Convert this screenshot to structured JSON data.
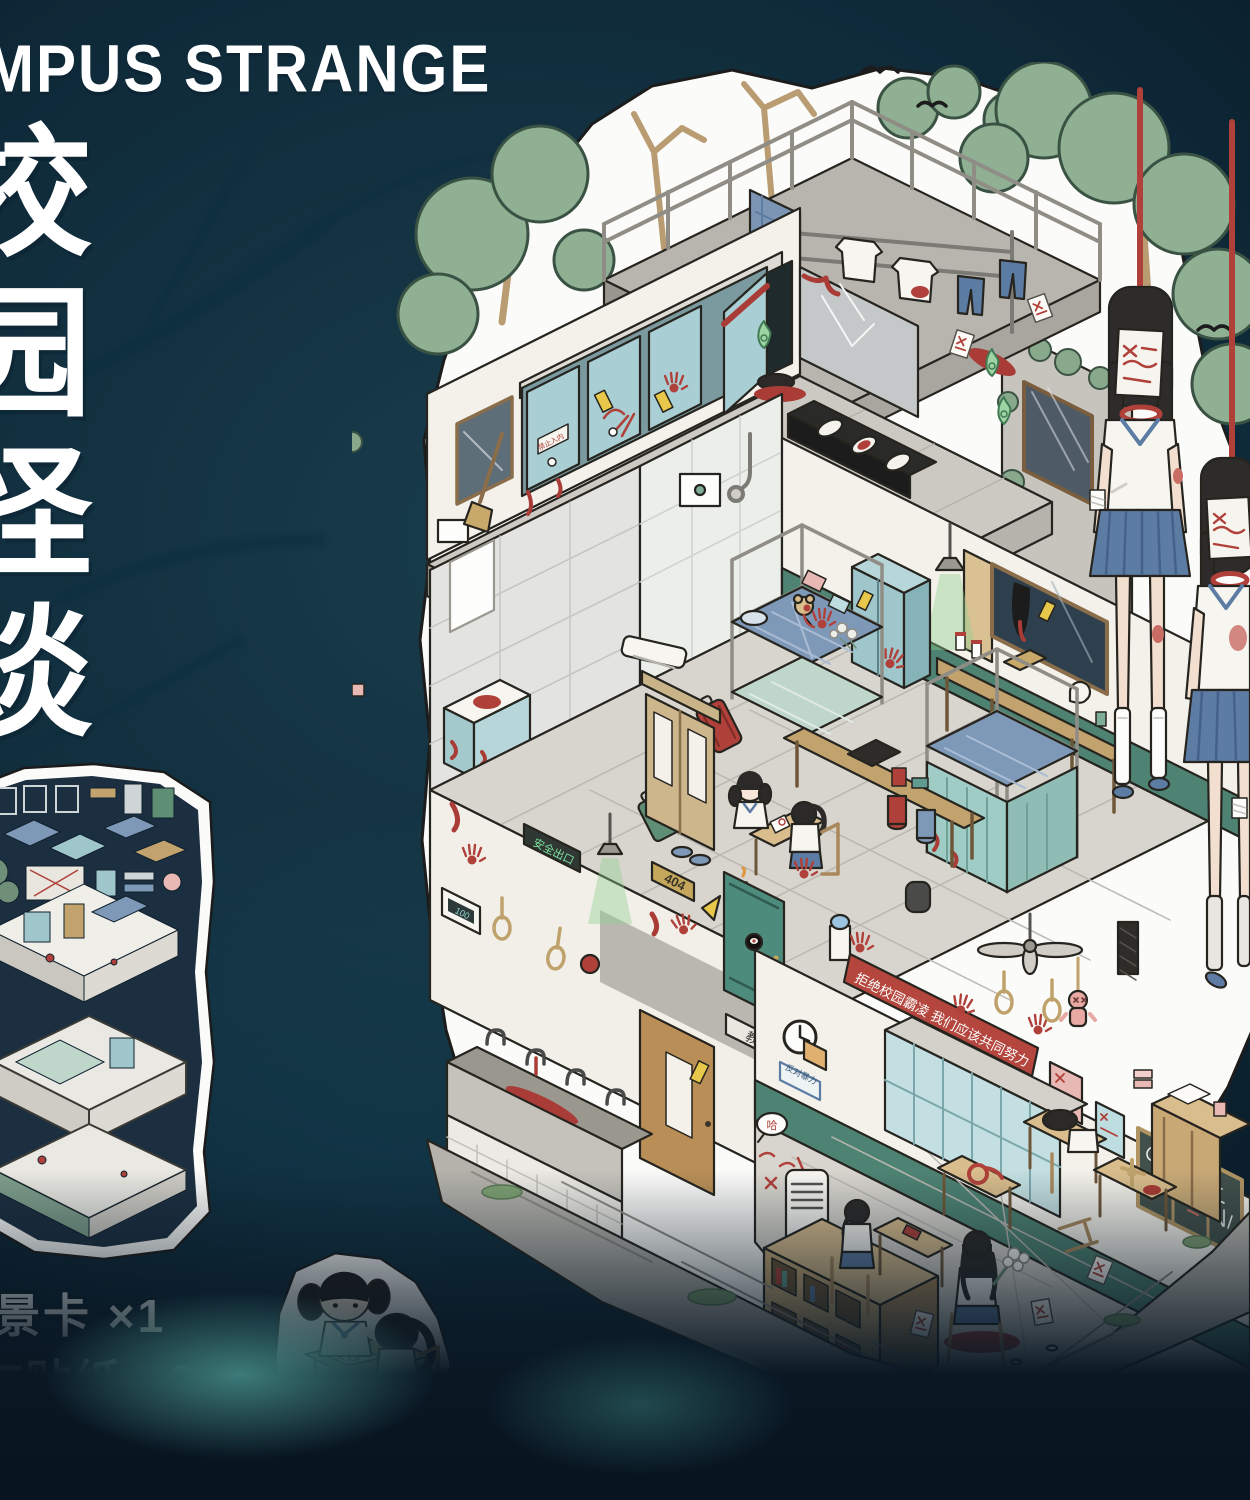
{
  "poster": {
    "title": "MPUS STRANGE",
    "vertical_title": "校园怪谈",
    "contents": [
      "景卡 ×1",
      "T贴纸 ×2",
      "景效果卡 ×1"
    ],
    "size_label": "尺寸： 29.2×20.6c"
  },
  "illustration": {
    "signs": {
      "banner": "拒绝校园霸凌 我们应该共同努力",
      "no_entry": "禁止入内",
      "safety_exit": "安全出口",
      "room_number": "404",
      "classroom": "教室",
      "meter": "100",
      "anti_violence": "反对暴力",
      "graffiti": "哈"
    }
  },
  "colors": {
    "background_teal": "#1c4a5c",
    "background_dark": "#081a27",
    "sticker_white": "#fbfbf9",
    "outline": "#26241f",
    "blood_red": "#a93c36",
    "banner_red": "#b5463e",
    "stall_teal": "#a9ced3",
    "locker_teal": "#c3dfe1",
    "wood_tan": "#c8a976",
    "uniform_blue": "#5d7ca3",
    "wainscot_green": "#4e8373",
    "ghost_green": "#8ecf8e",
    "tree_green": "#8fb093",
    "rope_red": "#b0413a",
    "rope_tan": "#bfa26b",
    "plaque_gold": "#c5a85c"
  }
}
